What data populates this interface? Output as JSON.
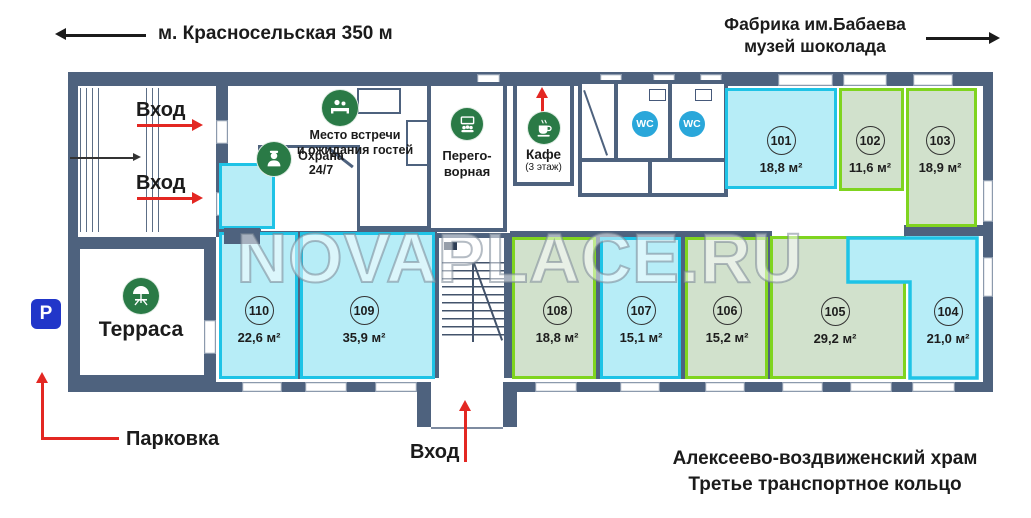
{
  "colors": {
    "wall": "#4e627e",
    "ink": "#1b1b1b",
    "red": "#e32722",
    "cyan": "#1ec3e6",
    "cyan-fill": "#b7edf7",
    "green": "#7fd41f",
    "green-fill": "#d1e1cc",
    "icon-green": "#2a7a46",
    "wc-blue": "#2aa7da",
    "parking-blue": "#2136c9"
  },
  "header": {
    "metro": "м. Красносельская 350 м",
    "factory_line1": "Фабрика им.Бабаева",
    "factory_line2": "музей шоколада"
  },
  "labels": {
    "entrance": "Вход",
    "meeting_line1": "Место встречи",
    "meeting_line2": "и ожидания гостей",
    "security_line1": "Охрана",
    "security_line2": "24/7",
    "meeting_room_line1": "Перего-",
    "meeting_room_line2": "ворная",
    "cafe": "Кафе",
    "cafe_floor": "(3 этаж)",
    "wc": "WC",
    "terrace": "Терраса",
    "parking_sign": "P",
    "parking": "Парковка"
  },
  "footer": {
    "landmark_line1": "Алексеево-воздвиженский храм",
    "landmark_line2": "Третье транспортное кольцо"
  },
  "watermark": "NOVAPLACE.RU",
  "rooms": [
    {
      "number": "101",
      "area": "18,8 м²",
      "style": "cyan"
    },
    {
      "number": "102",
      "area": "11,6 м²",
      "style": "green"
    },
    {
      "number": "103",
      "area": "18,9 м²",
      "style": "green"
    },
    {
      "number": "104",
      "area": "21,0 м²",
      "style": "cyan"
    },
    {
      "number": "105",
      "area": "29,2 м²",
      "style": "green"
    },
    {
      "number": "106",
      "area": "15,2 м²",
      "style": "green"
    },
    {
      "number": "107",
      "area": "15,1 м²",
      "style": "cyan"
    },
    {
      "number": "108",
      "area": "18,8 м²",
      "style": "green"
    },
    {
      "number": "109",
      "area": "35,9 м²",
      "style": "cyan"
    },
    {
      "number": "110",
      "area": "22,6 м²",
      "style": "cyan"
    }
  ]
}
